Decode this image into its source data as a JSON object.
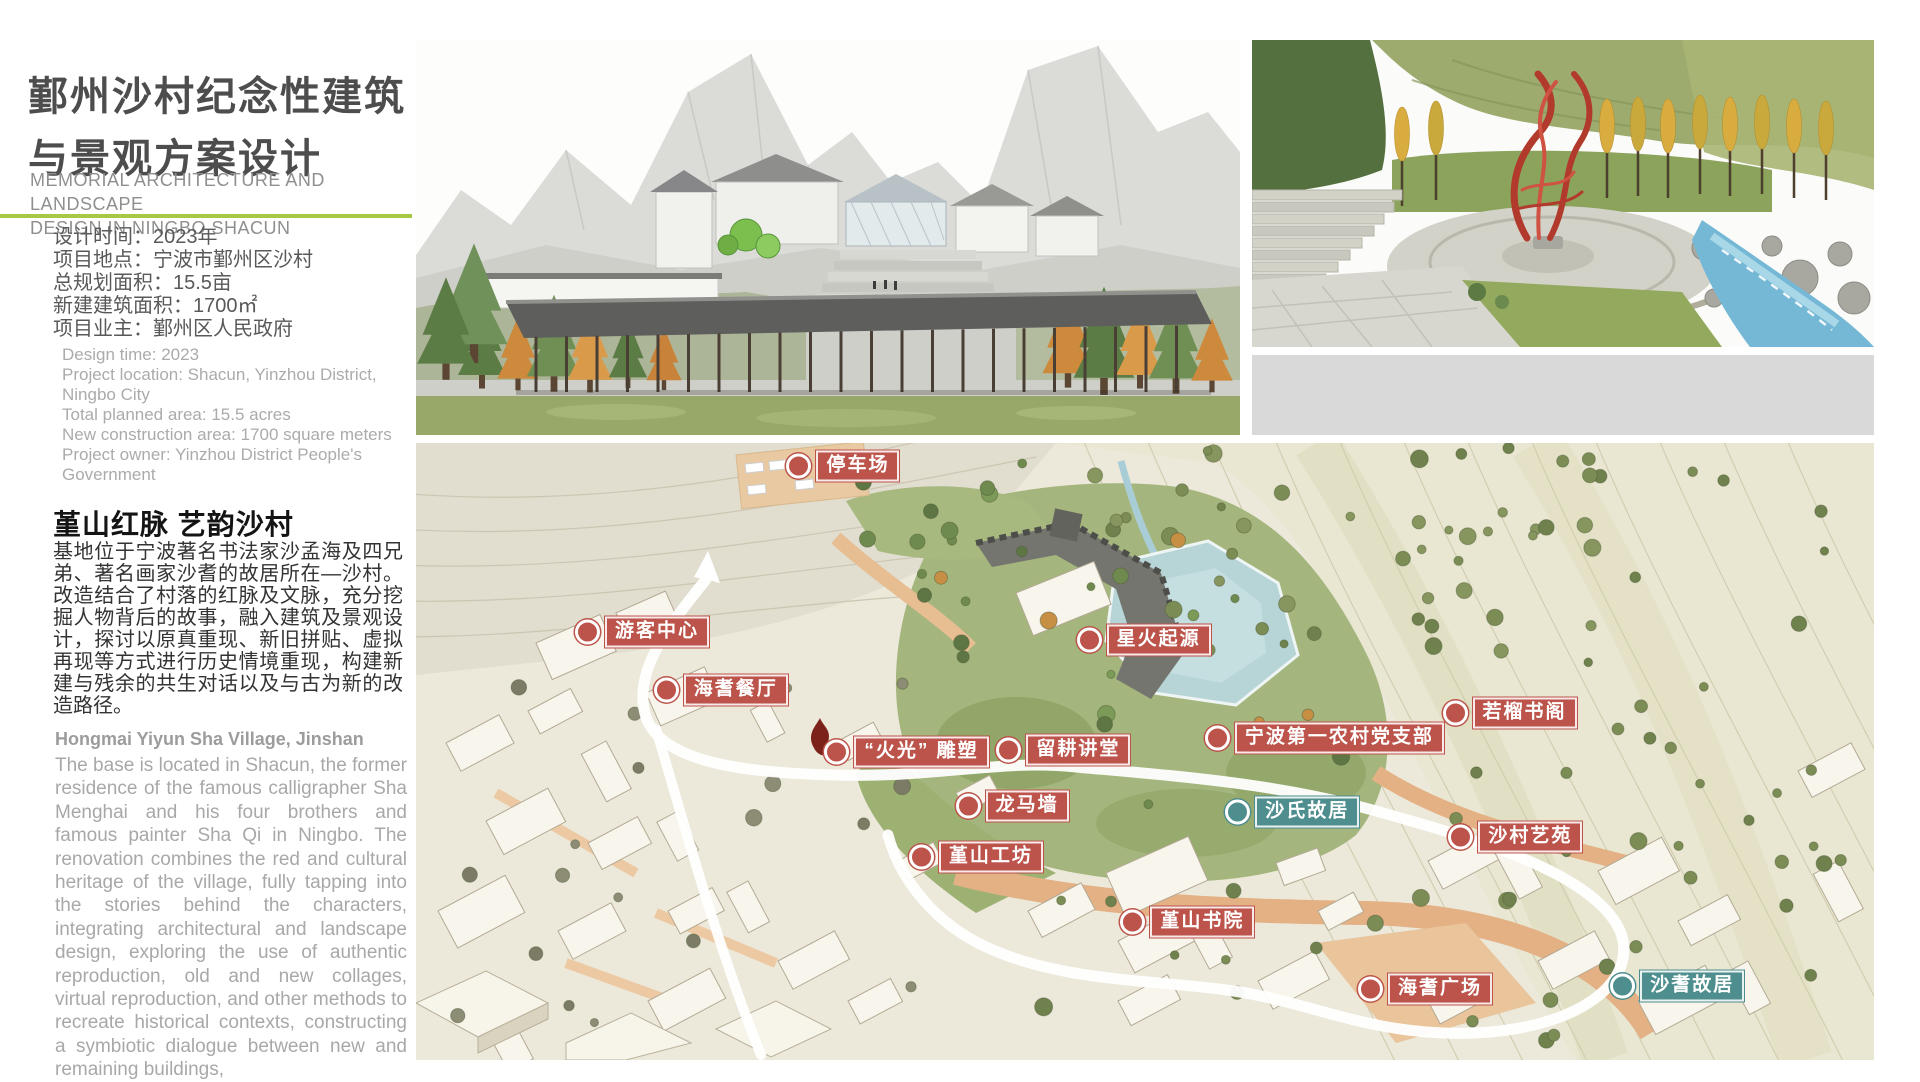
{
  "header": {
    "title_zh_line1": "鄞州沙村纪念性建筑",
    "title_zh_line2": "与景观方案设计",
    "subtitle_en_line1": "MEMORIAL ARCHITECTURE AND LANDSCAPE",
    "subtitle_en_line2": "DESIGN IN NINGBO SHACUN",
    "accent_color": "#a6c842"
  },
  "project_info": {
    "zh_lines": [
      "设计时间：2023年",
      "项目地点：宁波市鄞州区沙村",
      "总规划面积：15.5亩",
      "新建建筑面积：1700㎡",
      "项目业主：鄞州区人民政府"
    ],
    "en_lines": [
      "Design time: 2023",
      "Project location: Shacun, Yinzhou District, Ningbo City",
      "Total planned area: 15.5 acres",
      "New construction area: 1700 square meters",
      "Project owner: Yinzhou District People's Government"
    ]
  },
  "intro": {
    "heading_zh": "堇山红脉 艺韵沙村",
    "paragraph_zh": "基地位于宁波著名书法家沙孟海及四兄弟、著名画家沙耆的故居所在—沙村。改造结合了村落的红脉及文脉，充分挖掘人物背后的故事，融入建筑及景观设计，探讨以原真重现、新旧拼贴、虚拟再现等方式进行历史情境重现，构建新建与残余的共生对话以及与古为新的改造路径。",
    "heading_en": "Hongmai Yiyun Sha Village, Jinshan",
    "paragraph_en": "The base is located in Shacun, the former residence of the famous calligrapher Sha Menghai and his four brothers and famous painter Sha Qi in Ningbo. The renovation combines the red and cultural heritage of the village, fully tapping into the stories behind the characters, integrating architectural and landscape design, exploring the use of authentic reproduction, old and new collages, virtual reproduction, and other methods to recreate historical contexts, constructing a symbiotic dialogue between new and remaining buildings,"
  },
  "site_plan": {
    "marker_colors": {
      "red": "#bc544b",
      "teal": "#4f8e8e"
    },
    "labels": [
      {
        "text": "停车场",
        "type": "red",
        "x": 26.3,
        "y": 3.7
      },
      {
        "text": "游客中心",
        "type": "red",
        "x": 11.8,
        "y": 30.6
      },
      {
        "text": "海耆餐厅",
        "type": "red",
        "x": 17.2,
        "y": 40.0
      },
      {
        "text": "“火光” 雕塑",
        "type": "red",
        "x": 28.9,
        "y": 50.1
      },
      {
        "text": "留耕讲堂",
        "type": "red",
        "x": 40.7,
        "y": 49.8
      },
      {
        "text": "星火起源",
        "type": "red",
        "x": 46.2,
        "y": 31.9
      },
      {
        "text": "宁波第一农村党支部",
        "type": "red",
        "x": 55.0,
        "y": 47.8
      },
      {
        "text": "若榴书阁",
        "type": "red",
        "x": 71.3,
        "y": 43.8
      },
      {
        "text": "沙氏故居",
        "type": "teal",
        "x": 56.4,
        "y": 59.8
      },
      {
        "text": "龙马墙",
        "type": "red",
        "x": 37.9,
        "y": 58.8
      },
      {
        "text": "堇山工坊",
        "type": "red",
        "x": 34.7,
        "y": 67.1
      },
      {
        "text": "沙村艺苑",
        "type": "red",
        "x": 71.7,
        "y": 63.9
      },
      {
        "text": "堇山书院",
        "type": "red",
        "x": 49.2,
        "y": 77.6
      },
      {
        "text": "海耆广场",
        "type": "red",
        "x": 65.5,
        "y": 88.5
      },
      {
        "text": "沙耆故居",
        "type": "teal",
        "x": 82.8,
        "y": 88.0
      }
    ]
  }
}
